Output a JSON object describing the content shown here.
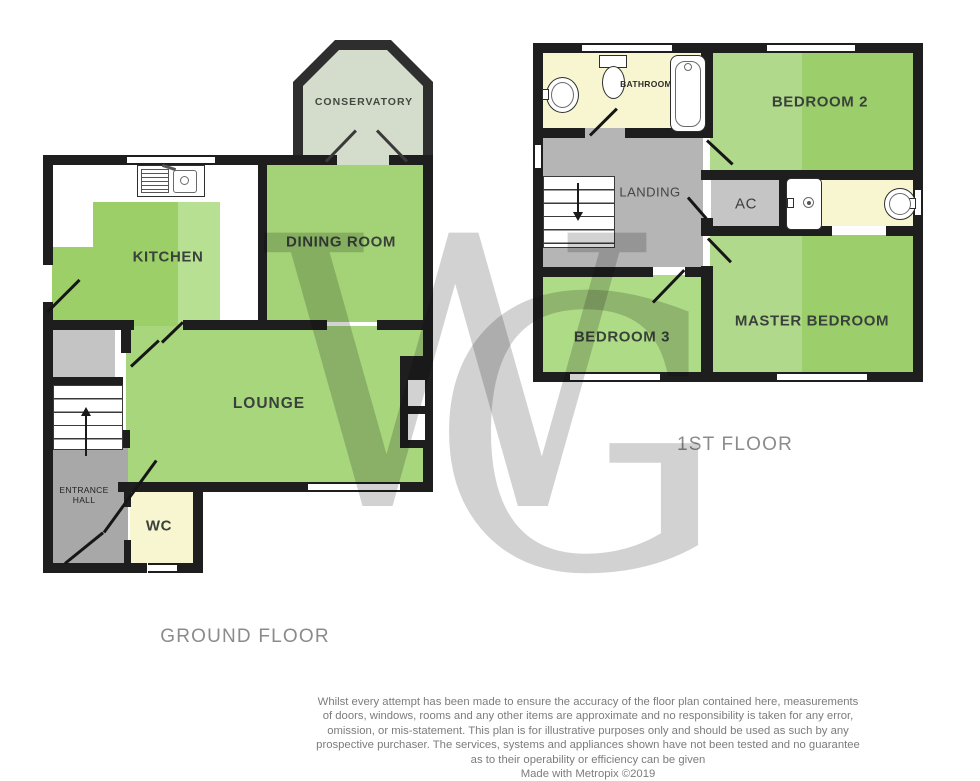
{
  "watermark": {
    "letter_w": "W",
    "letter_g": "G"
  },
  "ground_floor": {
    "title": "GROUND FLOOR",
    "rooms": {
      "kitchen": "KITCHEN",
      "dining_room": "DINING ROOM",
      "conservatory": "CONSERVATORY",
      "lounge": "LOUNGE",
      "entrance_hall": "ENTRANCE\nHALL",
      "wc": "WC"
    }
  },
  "first_floor": {
    "title": "1ST FLOOR",
    "rooms": {
      "bathroom": "BATHROOM",
      "bedroom_2": "BEDROOM 2",
      "landing": "LANDING",
      "airing_cupboard": "AC",
      "bedroom_3": "BEDROOM 3",
      "master_bedroom": "MASTER BEDROOM"
    }
  },
  "icons": {
    "stairs_up": "arrow-up",
    "stairs_down": "arrow-down",
    "fixtures": [
      "kitchen-sink",
      "toilet",
      "bathtub",
      "wash-basin",
      "shower",
      "wash-basin"
    ]
  },
  "footer": {
    "disclaimer": "Whilst every attempt has been made to ensure the accuracy of the floor plan contained here, measurements\nof doors, windows, rooms and any other items are approximate and no responsibility is taken for any error,\nomission, or mis-statement. This plan is for illustrative purposes only and should be used as such by any\nprospective purchaser. The services, systems and appliances shown have not been tested and no guarantee\nas to their operability or efficiency can be given",
    "credit": "Made with Metropix ©2019"
  },
  "colors": {
    "wall": "#1e1e1e",
    "room_green": "#a3d376",
    "room_green_light": "#b7e092",
    "room_yellow": "#f8f6d0",
    "hall_gray": "#a8a8a8",
    "landing_gray": "#b5b5b5",
    "cupboard_gray": "#c4c4c4",
    "conservatory_floor": "#d4dccb",
    "floor_title_text": "#8b8b8b",
    "disclaimer_text": "#7c7c7c"
  }
}
